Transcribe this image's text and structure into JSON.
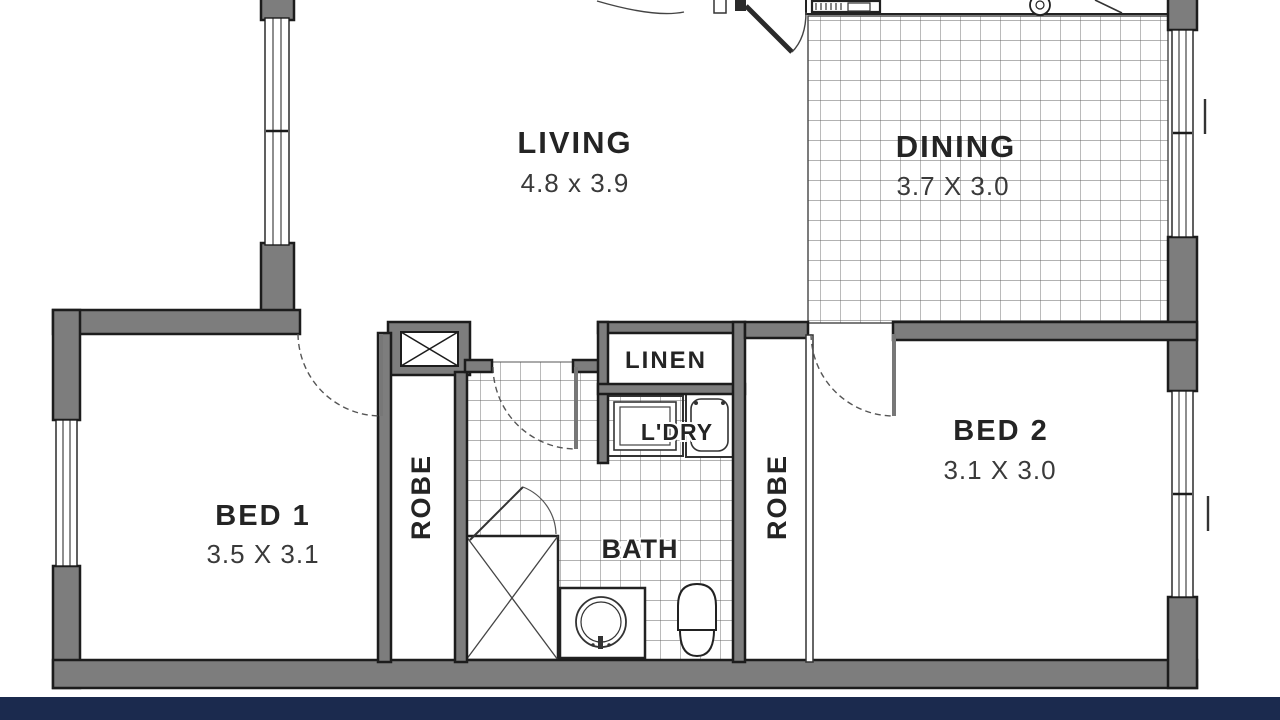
{
  "plan": {
    "title": "floor-plan",
    "colors": {
      "footer_navy": "#1b2a4e",
      "wall_fill": "#7d7d7d",
      "wall_edge": "#1c1c1c",
      "tile_line": "#666666",
      "background": "#ffffff"
    },
    "rooms": {
      "living": {
        "name": "LIVING",
        "dims": "4.8 x 3.9"
      },
      "dining": {
        "name": "DINING",
        "dims": "3.7 X 3.0"
      },
      "bed1": {
        "name": "BED 1",
        "dims": "3.5 X 3.1"
      },
      "bed2": {
        "name": "BED 2",
        "dims": "3.1 X 3.0"
      },
      "bath": {
        "name": "BATH"
      },
      "linen": {
        "name": "LINEN"
      },
      "laundry": {
        "name": "L'DRY"
      },
      "robe1": {
        "name": "ROBE"
      },
      "robe2": {
        "name": "ROBE"
      }
    }
  }
}
